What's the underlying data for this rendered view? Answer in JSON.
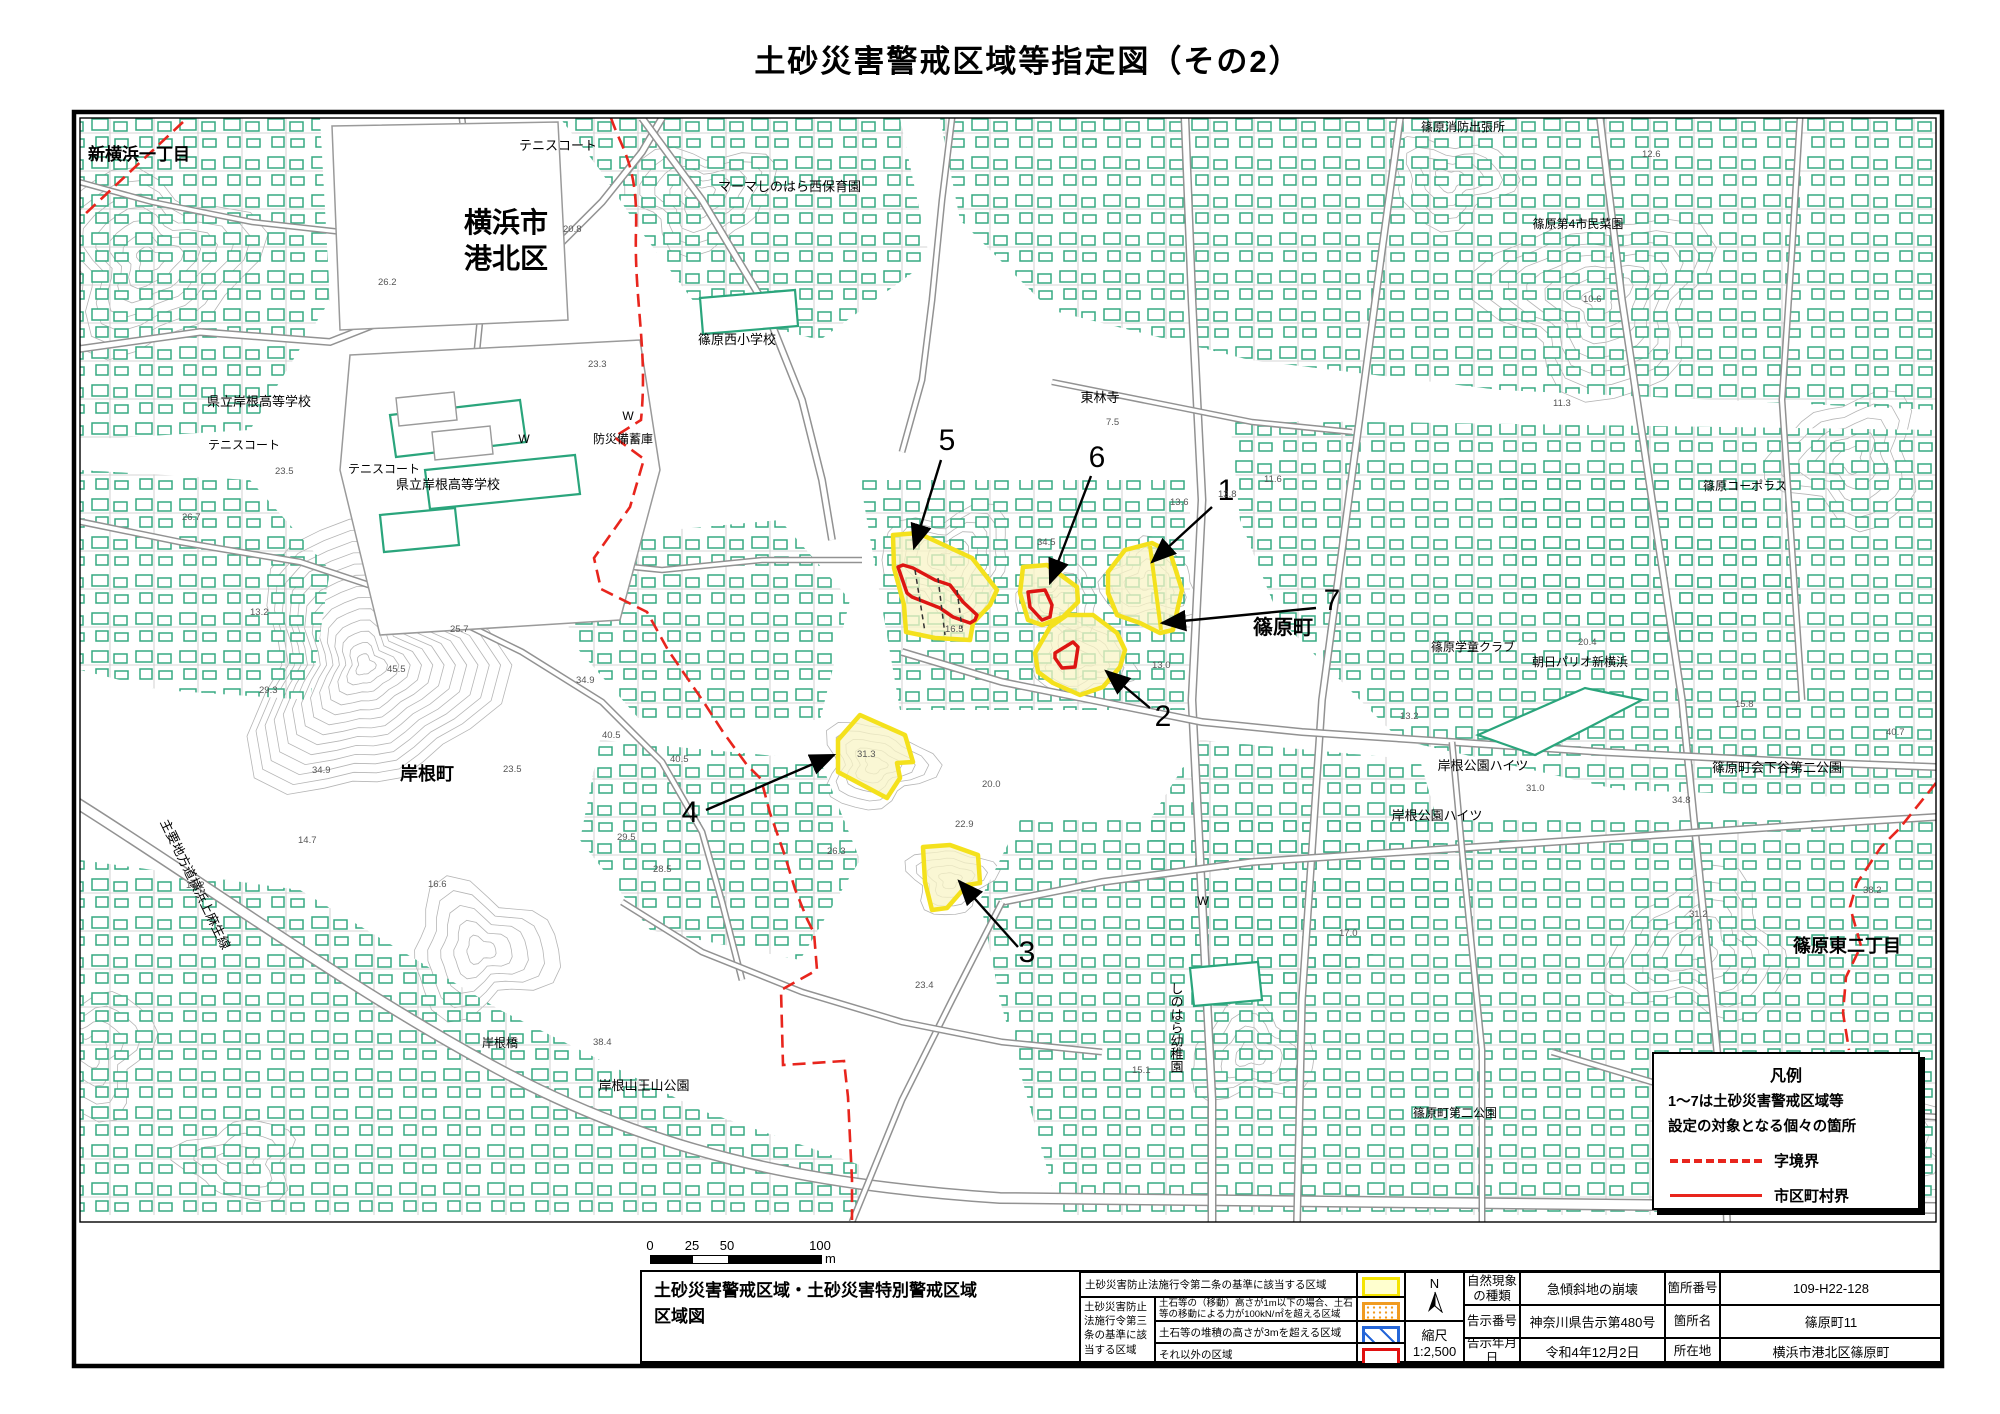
{
  "title": "土砂災害警戒区域等指定図（その2）",
  "scale_bar": {
    "ticks": [
      "0",
      "25",
      "50",
      "100"
    ],
    "unit": "m"
  },
  "legend_box": {
    "title": "凡例",
    "line1": "1〜7は土砂災害警戒区域等",
    "line2": "設定の対象となる個々の箇所",
    "dashed_label": "字境界",
    "solid_label": "市区町村界"
  },
  "info_table": {
    "map_title_line1": "土砂災害警戒区域・土砂災害特別警戒区域",
    "map_title_line2": "区域図",
    "group_label": "土砂災害防止法施行令第三条の基準に該当する区域",
    "rows": [
      {
        "desc": "土砂災害防止法施行令第二条の基準に該当する区域",
        "swatch": "yellow"
      },
      {
        "desc": "土石等の（移動）高さが1m以下の場合、土石等の移動による力が100kN/㎡を超える区域",
        "swatch": "orange-dots"
      },
      {
        "desc": "土石等の堆積の高さが3mを超える区域",
        "swatch": "blue-hatch"
      },
      {
        "desc": "それ以外の区域",
        "swatch": "red-outline"
      }
    ],
    "north_label": "N",
    "scale_label": "縮尺",
    "scale_value": "1:2,500",
    "fields": [
      {
        "label": "自然現象の種類",
        "value": "急傾斜地の崩壊"
      },
      {
        "label": "告示番号",
        "value": "神奈川県告示第480号"
      },
      {
        "label": "告示年月日",
        "value": "令和4年12月2日"
      },
      {
        "label": "箇所番号",
        "value": "109-H22-128"
      },
      {
        "label": "箇所名",
        "value": "篠原町11"
      },
      {
        "label": "所在地",
        "value": "横浜市港北区篠原町"
      }
    ]
  },
  "map": {
    "colors": {
      "hazard_yellow": "#f4e11c",
      "hazard_fill": "#f8f4c6",
      "special_red": "#dd1512",
      "boundary_red": "#e8251d",
      "building_teal": "#2aa57c",
      "contour_gray": "#b5b5b5"
    },
    "labels": [
      {
        "t": "新横浜一丁目",
        "x": 88,
        "y": 160,
        "s": 17,
        "a": "s"
      },
      {
        "t": "テニスコート",
        "x": 519,
        "y": 150,
        "s": 13,
        "a": "s"
      },
      {
        "t": "マーマしのはら西保育園",
        "x": 718,
        "y": 191,
        "s": 13,
        "a": "s"
      },
      {
        "t": "横浜市",
        "x": 506,
        "y": 232,
        "s": 28,
        "a": "m"
      },
      {
        "t": "港北区",
        "x": 506,
        "y": 268,
        "s": 28,
        "a": "m"
      },
      {
        "t": "篠原西小学校",
        "x": 737,
        "y": 344,
        "s": 13,
        "a": "m"
      },
      {
        "t": "県立岸根高等学校",
        "x": 259,
        "y": 406,
        "s": 13,
        "a": "m"
      },
      {
        "t": "テニスコート",
        "x": 244,
        "y": 449,
        "s": 12,
        "a": "m"
      },
      {
        "t": "テニスコート",
        "x": 384,
        "y": 473,
        "s": 12,
        "a": "m"
      },
      {
        "t": "県立岸根高等学校",
        "x": 448,
        "y": 489,
        "s": 13,
        "a": "m"
      },
      {
        "t": "防災備蓄庫",
        "x": 623,
        "y": 443,
        "s": 12,
        "a": "m"
      },
      {
        "t": "東林寺",
        "x": 1100,
        "y": 402,
        "s": 13,
        "a": "m"
      },
      {
        "t": "篠原消防出張所",
        "x": 1463,
        "y": 131,
        "s": 12,
        "a": "m"
      },
      {
        "t": "篠原第4市民菜園",
        "x": 1578,
        "y": 228,
        "s": 12,
        "a": "m"
      },
      {
        "t": "篠原コーポラス",
        "x": 1745,
        "y": 490,
        "s": 12,
        "a": "m"
      },
      {
        "t": "篠原町",
        "x": 1283,
        "y": 634,
        "s": 20,
        "a": "m"
      },
      {
        "t": "篠原学童クラブ",
        "x": 1473,
        "y": 651,
        "s": 12,
        "a": "m"
      },
      {
        "t": "朝日パリオ新横浜",
        "x": 1580,
        "y": 666,
        "s": 12,
        "a": "m"
      },
      {
        "t": "岸根公園ハイツ",
        "x": 1483,
        "y": 770,
        "s": 13,
        "a": "m"
      },
      {
        "t": "岸根公園ハイツ",
        "x": 1437,
        "y": 820,
        "s": 13,
        "a": "m"
      },
      {
        "t": "篠原町会下谷第二公園",
        "x": 1777,
        "y": 772,
        "s": 13,
        "a": "m"
      },
      {
        "t": "篠原東二丁目",
        "x": 1847,
        "y": 952,
        "s": 18,
        "a": "m"
      },
      {
        "t": "岸根町",
        "x": 427,
        "y": 780,
        "s": 18,
        "a": "m"
      },
      {
        "t": "主要地方道横浜上麻生線",
        "x": 160,
        "y": 822,
        "s": 13,
        "a": "s",
        "r": 64
      },
      {
        "t": "しのはら幼稚園",
        "x": 1176,
        "y": 982,
        "s": 13,
        "a": "s",
        "v": true
      },
      {
        "t": "岸根橋",
        "x": 500,
        "y": 1047,
        "s": 12,
        "a": "m"
      },
      {
        "t": "岸根山王山公園",
        "x": 644,
        "y": 1090,
        "s": 13,
        "a": "m"
      },
      {
        "t": "篠原町第二公園",
        "x": 1455,
        "y": 1117,
        "s": 12,
        "a": "m"
      },
      {
        "t": "W",
        "x": 524,
        "y": 443,
        "s": 12,
        "a": "m"
      },
      {
        "t": "W",
        "x": 628,
        "y": 420,
        "s": 12,
        "a": "m"
      },
      {
        "t": "W",
        "x": 1203,
        "y": 905,
        "s": 12,
        "a": "m"
      }
    ],
    "spot_elevations": [
      {
        "v": "20.8",
        "x": 563,
        "y": 232
      },
      {
        "v": "26.2",
        "x": 378,
        "y": 285
      },
      {
        "v": "23.3",
        "x": 588,
        "y": 367
      },
      {
        "v": "23.5",
        "x": 275,
        "y": 474
      },
      {
        "v": "26.7",
        "x": 182,
        "y": 520
      },
      {
        "v": "13.2",
        "x": 250,
        "y": 615
      },
      {
        "v": "29.3",
        "x": 259,
        "y": 693
      },
      {
        "v": "45.5",
        "x": 387,
        "y": 672
      },
      {
        "v": "34.9",
        "x": 312,
        "y": 773
      },
      {
        "v": "25.7",
        "x": 450,
        "y": 632
      },
      {
        "v": "34.9",
        "x": 576,
        "y": 683
      },
      {
        "v": "40.5",
        "x": 602,
        "y": 738
      },
      {
        "v": "14.7",
        "x": 298,
        "y": 843
      },
      {
        "v": "16.6",
        "x": 428,
        "y": 887
      },
      {
        "v": "23.5",
        "x": 503,
        "y": 772
      },
      {
        "v": "29.5",
        "x": 617,
        "y": 840
      },
      {
        "v": "13.2",
        "x": 186,
        "y": 888
      },
      {
        "v": "40.5",
        "x": 670,
        "y": 762
      },
      {
        "v": "31.3",
        "x": 857,
        "y": 757
      },
      {
        "v": "20.0",
        "x": 982,
        "y": 787
      },
      {
        "v": "22.9",
        "x": 955,
        "y": 827
      },
      {
        "v": "26.3",
        "x": 827,
        "y": 854
      },
      {
        "v": "28.5",
        "x": 653,
        "y": 872
      },
      {
        "v": "7.5",
        "x": 1106,
        "y": 425
      },
      {
        "v": "11.6",
        "x": 1264,
        "y": 482
      },
      {
        "v": "13.6",
        "x": 1170,
        "y": 505
      },
      {
        "v": "34.5",
        "x": 1037,
        "y": 545
      },
      {
        "v": "16.5",
        "x": 945,
        "y": 632
      },
      {
        "v": "13.0",
        "x": 1152,
        "y": 668
      },
      {
        "v": "13.2",
        "x": 1400,
        "y": 719
      },
      {
        "v": "20.4",
        "x": 1578,
        "y": 645
      },
      {
        "v": "31.0",
        "x": 1526,
        "y": 791
      },
      {
        "v": "34.8",
        "x": 1672,
        "y": 803
      },
      {
        "v": "40.7",
        "x": 1886,
        "y": 735
      },
      {
        "v": "38.2",
        "x": 1863,
        "y": 893
      },
      {
        "v": "31.2",
        "x": 1689,
        "y": 917
      },
      {
        "v": "38.4",
        "x": 593,
        "y": 1045
      },
      {
        "v": "15.1",
        "x": 1132,
        "y": 1073
      },
      {
        "v": "17.0",
        "x": 1339,
        "y": 936
      },
      {
        "v": "23.4",
        "x": 915,
        "y": 988
      },
      {
        "v": "15.8",
        "x": 1735,
        "y": 707
      },
      {
        "v": "8.7",
        "x": 1385,
        "y": 113
      },
      {
        "v": "12.6",
        "x": 1642,
        "y": 157
      },
      {
        "v": "10.6",
        "x": 1583,
        "y": 302
      },
      {
        "v": "11.3",
        "x": 1553,
        "y": 406
      },
      {
        "v": "13.8",
        "x": 1218,
        "y": 497
      }
    ],
    "zones": [
      {
        "id": 1,
        "points": "1108,572 1125,550 1152,543 1170,552 1182,590 1178,607 1173,630 1160,633 1140,623 1117,615 1108,593",
        "divider": "1150,546 1161,630"
      },
      {
        "id": 2,
        "points": "1035,653 1050,627 1067,615 1093,615 1117,633 1125,650 1120,667 1103,687 1080,695 1053,683 1038,672",
        "red": "1055,653 1073,642 1078,647 1075,667 1062,668 1055,658"
      },
      {
        "id": 3,
        "points": "923,847 950,845 978,855 980,883 967,885 947,908 932,910 925,882"
      },
      {
        "id": 4,
        "points": "838,740 860,715 905,735 913,762 897,763 900,778 887,798 838,772"
      },
      {
        "id": 5,
        "points": "893,535 918,533 972,558 997,590 990,605 973,623 970,640 935,638 906,632 904,605 894,568",
        "red": "898,567 903,565 913,568 935,580 950,585 963,602 977,615 975,620 970,623 953,617 940,608 912,597 907,593",
        "dashes": [
          "915,570 925,632",
          "938,578 945,635",
          "957,590 962,628"
        ]
      },
      {
        "id": 6,
        "points": "1023,567 1047,565 1077,587 1078,602 1063,617 1042,625 1028,620 1020,593",
        "red": "1028,592 1045,590 1052,605 1050,617 1042,620 1030,607"
      }
    ],
    "numbers": [
      {
        "n": "1",
        "x": 1226,
        "y": 500,
        "ax": 1212,
        "ay": 507,
        "bx": 1152,
        "by": 562
      },
      {
        "n": "2",
        "x": 1163,
        "y": 726,
        "ax": 1150,
        "ay": 708,
        "bx": 1106,
        "by": 671
      },
      {
        "n": "3",
        "x": 1027,
        "y": 962,
        "ax": 1018,
        "ay": 947,
        "bx": 959,
        "by": 881
      },
      {
        "n": "4",
        "x": 690,
        "y": 822,
        "ax": 706,
        "ay": 810,
        "bx": 834,
        "by": 755
      },
      {
        "n": "5",
        "x": 947,
        "y": 450,
        "ax": 941,
        "ay": 460,
        "bx": 914,
        "by": 548
      },
      {
        "n": "6",
        "x": 1097,
        "y": 467,
        "ax": 1091,
        "ay": 476,
        "bx": 1050,
        "by": 583
      },
      {
        "n": "7",
        "x": 1332,
        "y": 610,
        "ax": 1316,
        "ay": 608,
        "bx": 1162,
        "by": 623
      }
    ],
    "boundaries_dashed": [
      "M 183,122 L 83,216",
      "M 611,118 C 622,150 638,165 636,230 C 634,300 648,350 641,420 L 614,437 L 644,459 L 630,507 L 594,558 L 601,589 L 647,612 L 668,650 L 703,701 L 723,732 L 747,765 L 761,779 L 770,813 L 785,856 L 795,889 L 807,919 L 814,933 L 817,970 L 781,990 L 783,1065 L 844,1061 L 848,1097 L 852,1180 L 852,1220",
      "M 1936,783 L 1899,829 L 1881,847 L 1857,883 L 1850,907 L 1861,946 L 1846,977 L 1843,1013 L 1849,1050"
    ]
  }
}
